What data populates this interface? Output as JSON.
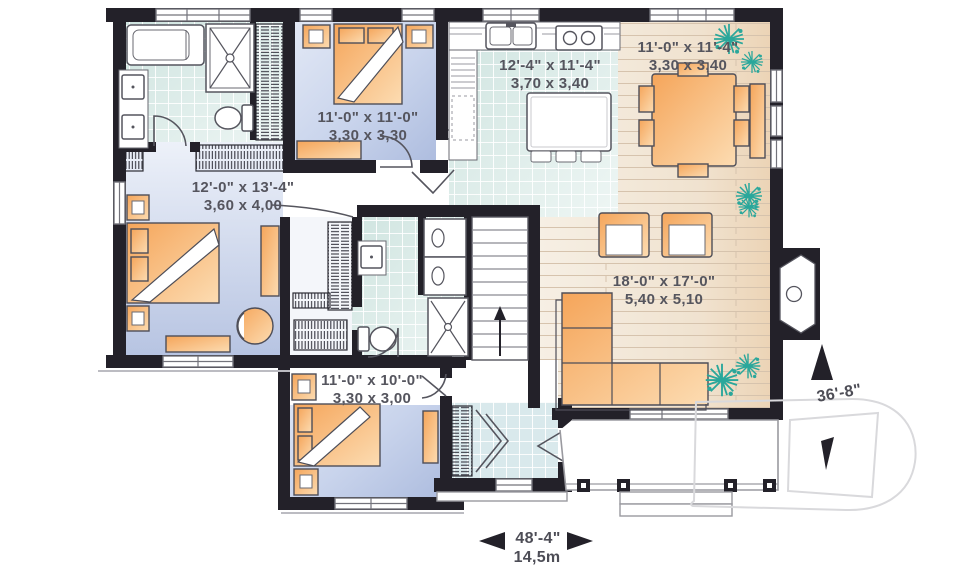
{
  "plan": {
    "type": "floor-plan",
    "rooms": {
      "bedroom_top": {
        "imperial": "11'-0\" x 11'-0\"",
        "metric": "3,30 x 3,30"
      },
      "kitchen": {
        "imperial": "12'-4\" x 11'-4\"",
        "metric": "3,70 x 3,40"
      },
      "dining_room": {
        "imperial": "11'-0\" x 11'-4\"",
        "metric": "3,30 x 3,40"
      },
      "master_bedroom": {
        "imperial": "12'-0\" x 13'-4\"",
        "metric": "3,60 x 4,00"
      },
      "living_room": {
        "imperial": "18'-0\" x 17'-0\"",
        "metric": "5,40 x 5,10"
      },
      "bedroom_bottom": {
        "imperial": "11'-0\" x 10'-0\"",
        "metric": "3,30 x 3,00"
      }
    },
    "overall_dimensions": {
      "width_imperial": "48'-4\"",
      "width_metric": "14,5m",
      "depth_imperial": "36'-8\""
    },
    "icons": {
      "plant": "starburst-plant",
      "stairs_direction": "up-arrow",
      "north_arrow": "solid-triangle",
      "dimension_arrows": "left-right-solid-triangles",
      "watermark": "letter-D-outline"
    },
    "colors": {
      "wall": "#232129",
      "bedroom_floor": "#bdcae5",
      "tile_floor": "#ddebe8",
      "wood_floor": "#f2e7d8",
      "furniture_orange": "#f6b065",
      "plant_teal": "#2aa79b",
      "label_text": "#55555e"
    }
  }
}
